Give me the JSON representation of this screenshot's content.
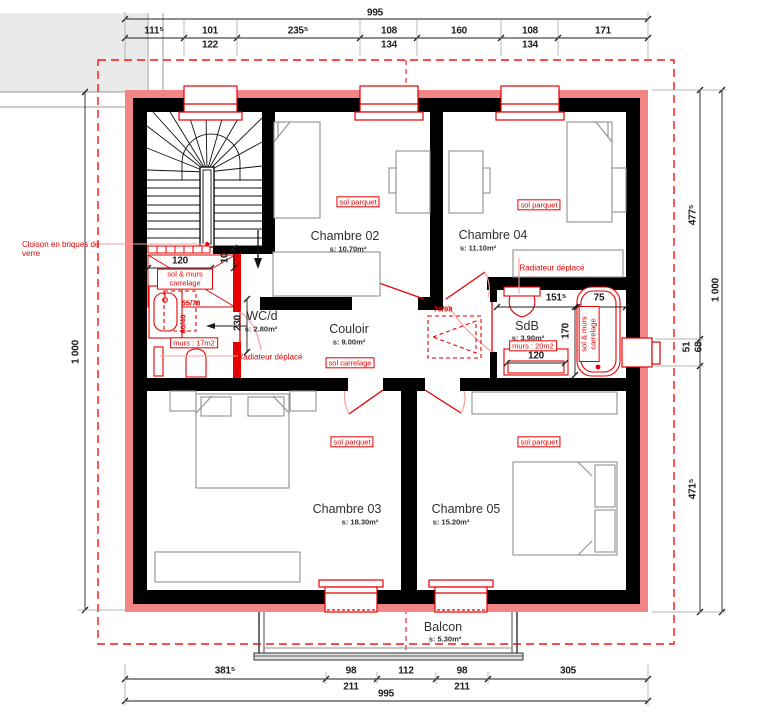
{
  "title": "Plan d'étage",
  "colors": {
    "wall_black": "#000000",
    "insulation_pink": "#f48585",
    "modification_red": "#e60000",
    "leader_pink": "#f4a0a0",
    "furniture_gray": "#8f8f8f",
    "neighbor_gray": "#eaeaea",
    "dim_text": "#1d1d1d"
  },
  "rooms": {
    "chambre02": {
      "name": "Chambre 02",
      "area": "s: 10.70m²",
      "finish": "sol parquet"
    },
    "chambre04": {
      "name": "Chambre 04",
      "area": "s: 11.10m²",
      "finish": "sol parquet"
    },
    "chambre03": {
      "name": "Chambre 03",
      "area": "s: 18.30m²",
      "finish": "sol parquet"
    },
    "chambre05": {
      "name": "Chambre 05",
      "area": "s: 15.20m²",
      "finish": "sol parquet"
    },
    "wc": {
      "name": "WC/d",
      "area": "s: 2.80m²",
      "walls_note": "murs : 17m2"
    },
    "couloir": {
      "name": "Couloir",
      "area": "s: 9.00m²",
      "finish": "sol carrelage"
    },
    "sdb": {
      "name": "SdB",
      "area": "s: 3.90m²",
      "walls_note": "murs : 20m2"
    },
    "balcon": {
      "name": "Balcon",
      "area": "s: 5.30m²"
    }
  },
  "annotations": {
    "cloison": "Cloison en briques de verre",
    "radiateur_wc": "Radiateur déplacé",
    "radiateur_ch04": "Radiateur déplacé",
    "closet_finish": "sol & murs carrelage",
    "bath_finish": "sol & murs carrelage",
    "sink_dim": "55/78",
    "sink_dim2": "60/40",
    "skylight_dim": "78/98"
  },
  "dims": {
    "top": {
      "total": "995",
      "s1": "111⁵",
      "s2": "101",
      "s2b": "122",
      "s3": "235⁵",
      "s4": "108",
      "s4b": "134",
      "s5": "160",
      "s6": "108",
      "s6b": "134",
      "s7": "171"
    },
    "bottom": {
      "total": "995",
      "s1": "381⁵",
      "s2": "98",
      "s2b": "211",
      "s3": "112",
      "s4": "98",
      "s4b": "211",
      "s5": "305"
    },
    "left": {
      "total": "1 000"
    },
    "right": {
      "s1": "477⁵",
      "s2": "51",
      "s2b": "68",
      "s3": "471⁵",
      "total": "1 000"
    },
    "interior": {
      "closet": "120",
      "wall": "10",
      "wc_h": "230",
      "sdb_w": "151⁵",
      "tub_w": "75",
      "sdb_h": "170",
      "vanity": "120"
    }
  }
}
